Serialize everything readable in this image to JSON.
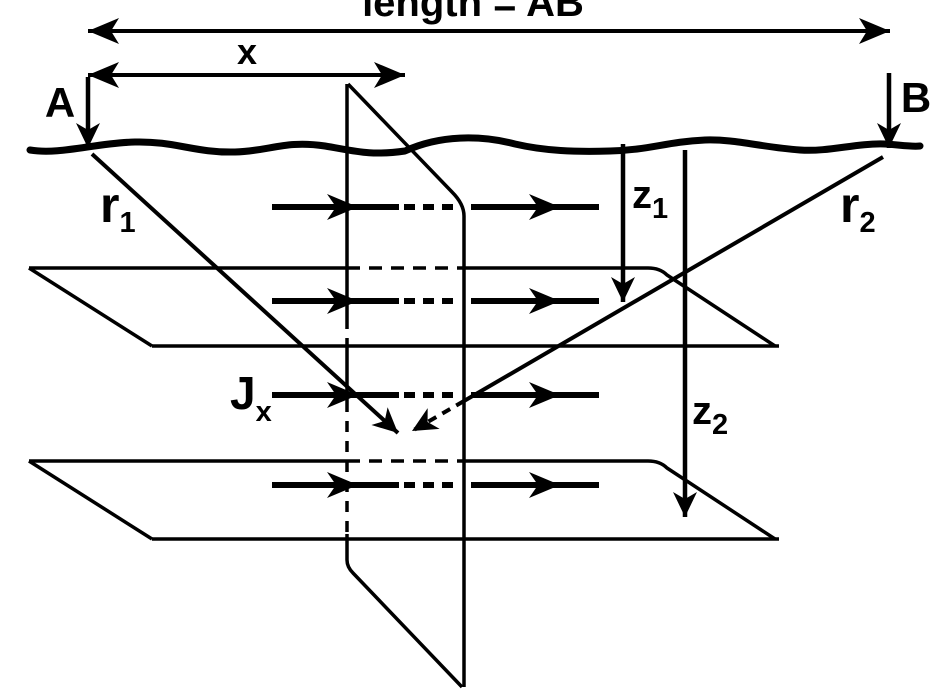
{
  "diagram": {
    "labels": {
      "ab": "length = AB",
      "x": "x",
      "a": "A",
      "b": "B",
      "r1": {
        "base": "r",
        "sub": "1"
      },
      "r2": {
        "base": "r",
        "sub": "2"
      },
      "z1": {
        "base": "z",
        "sub": "1"
      },
      "z2": {
        "base": "z",
        "sub": "2"
      },
      "jx": {
        "base": "J",
        "sub": "x"
      }
    },
    "colors": {
      "ink": "#000000",
      "paper": "#ffffff"
    }
  }
}
